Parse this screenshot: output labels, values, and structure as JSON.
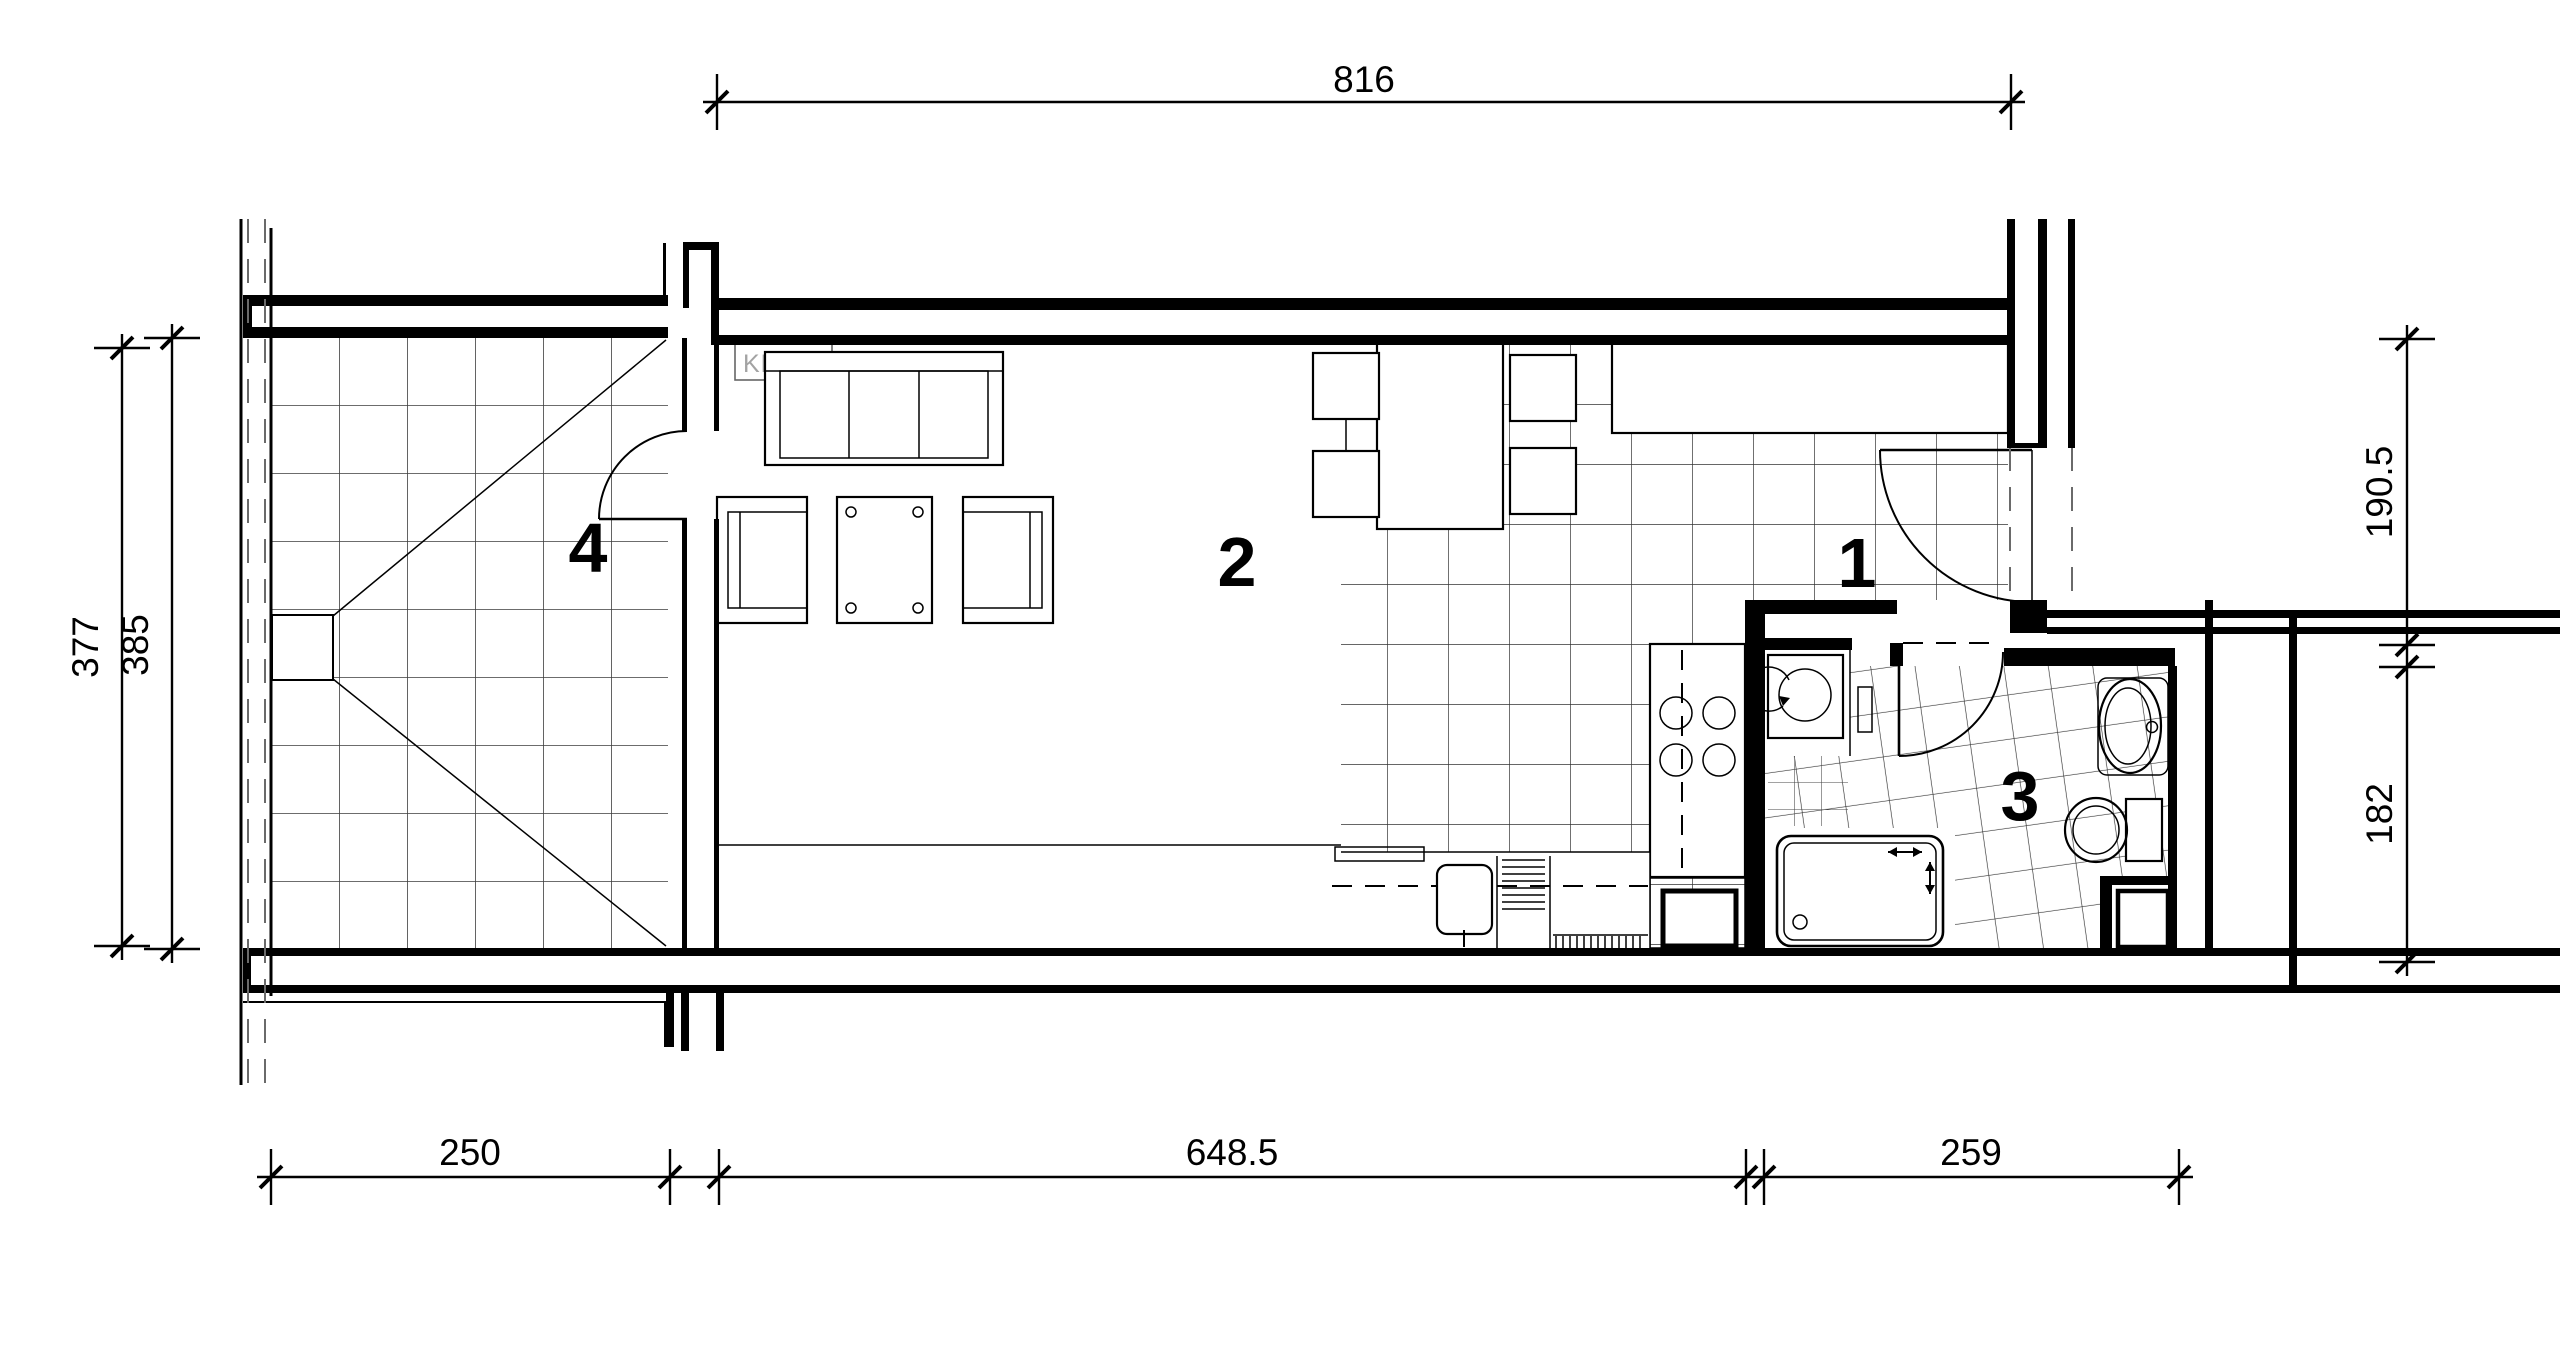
{
  "drawing": {
    "type": "architectural-floor-plan",
    "colors": {
      "background": "#ffffff",
      "line": "#000000",
      "tile_line": "#3c3c3c",
      "klima_text": "#a3a3a3"
    },
    "rooms": [
      {
        "id": "room-1",
        "label": "1",
        "kind": "hallway"
      },
      {
        "id": "room-2",
        "label": "2",
        "kind": "living-room"
      },
      {
        "id": "room-3",
        "label": "3",
        "kind": "bathroom"
      },
      {
        "id": "room-4",
        "label": "4",
        "kind": "terrace"
      }
    ],
    "dimensions": {
      "top": {
        "label": "816",
        "value": 816
      },
      "left_inner": {
        "label": "377",
        "value": 377
      },
      "left_outer": {
        "label": "385",
        "value": 385
      },
      "right_upper": {
        "label": "190.5",
        "value": 190.5
      },
      "right_lower": {
        "label": "182",
        "value": 182
      },
      "bottom_left": {
        "label": "250",
        "value": 250
      },
      "bottom_middle": {
        "label": "648.5",
        "value": 648.5
      },
      "bottom_right": {
        "label": "259",
        "value": 259
      }
    },
    "annotations": {
      "klima": "KLIMA"
    }
  }
}
